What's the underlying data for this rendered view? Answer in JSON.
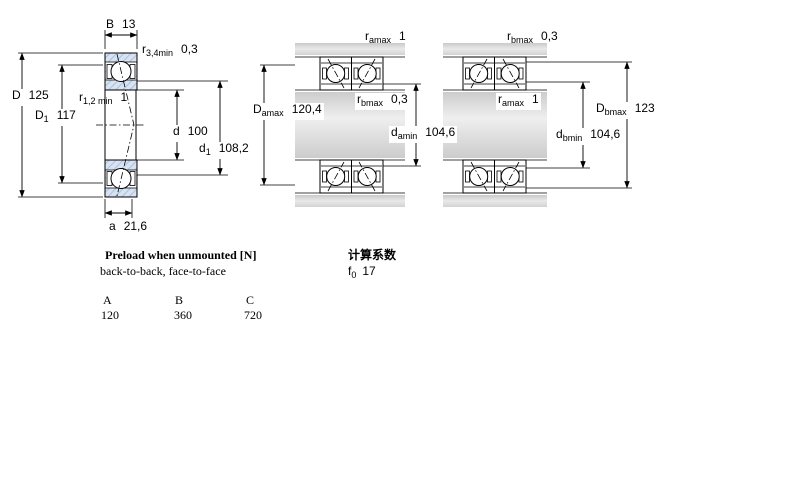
{
  "colors": {
    "ring_fill": "#d7e2f2",
    "ring_hatch": "#96aed2",
    "steel_grey": "#d2d2d2",
    "line": "#000000"
  },
  "left_view": {
    "width_B": {
      "sym": "B",
      "sub": "",
      "val": "13"
    },
    "chamfer_r34": {
      "sym": "r",
      "sub": "3,4min",
      "val": "0,3"
    },
    "outside_dia_D": {
      "sym": "D",
      "sub": "",
      "val": "125"
    },
    "shoulder_dia_D1": {
      "sym": "D",
      "sub": "1",
      "val": "117"
    },
    "chamfer_r12": {
      "sym": "r",
      "sub": "1,2 min",
      "val": "1"
    },
    "bore_dia_d": {
      "sym": "d",
      "sub": "",
      "val": "100"
    },
    "shoulder_dia_d1": {
      "sym": "d",
      "sub": "1",
      "val": "108,2"
    },
    "pressure_center_a": {
      "sym": "a",
      "sub": "",
      "val": "21,6"
    }
  },
  "back_to_back_view": {
    "ra_max": {
      "sym": "r",
      "sub": "amax",
      "val": "1"
    },
    "rb_max": {
      "sym": "r",
      "sub": "bmax",
      "val": "0,3"
    },
    "Da_max": {
      "sym": "D",
      "sub": "amax",
      "val": "120,4"
    },
    "da_min": {
      "sym": "d",
      "sub": "amin",
      "val": "104,6"
    }
  },
  "face_to_face_view": {
    "rb_max": {
      "sym": "r",
      "sub": "bmax",
      "val": "0,3"
    },
    "ra_max": {
      "sym": "r",
      "sub": "amax",
      "val": "1"
    },
    "Db_max": {
      "sym": "D",
      "sub": "bmax",
      "val": "123"
    },
    "db_min": {
      "sym": "d",
      "sub": "bmin",
      "val": "104,6"
    }
  },
  "preload": {
    "title": "Preload when unmounted [N]",
    "subtitle": "back-to-back, face-to-face",
    "columns": [
      "A",
      "B",
      "C"
    ],
    "values": [
      "120",
      "360",
      "720"
    ]
  },
  "calculation_factors": {
    "title": "计算系数",
    "f0": {
      "sym": "f",
      "sub": "0",
      "val": "17"
    }
  }
}
